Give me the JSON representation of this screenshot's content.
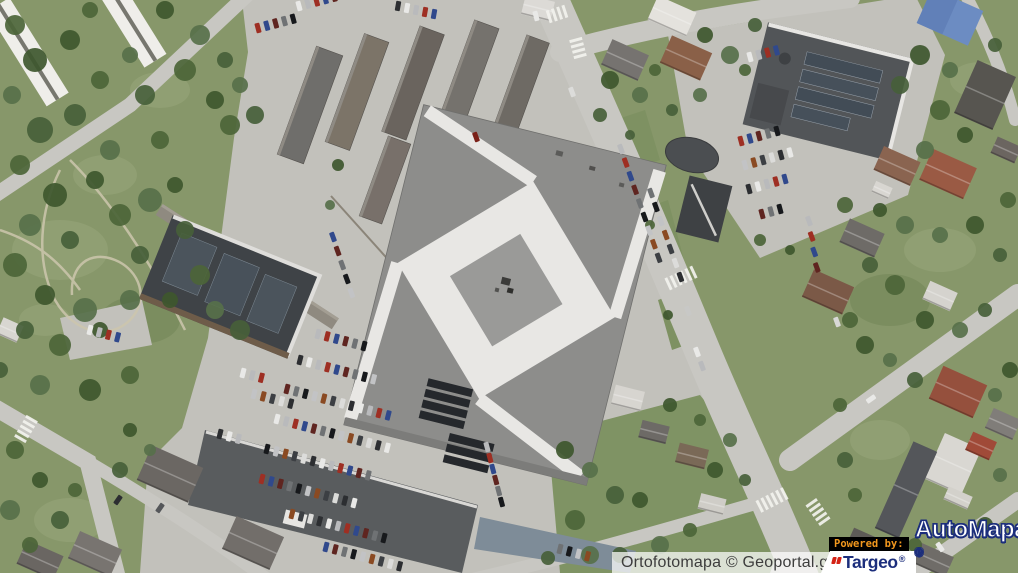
{
  "attribution": {
    "text": "Ortofotomapa © Geoportal.gov.pl"
  },
  "branding": {
    "powered_by": "Powered by:",
    "targeo": {
      "name": "Targeo",
      "registered": "®"
    },
    "automapa": {
      "name": "AutoMapa",
      "registered": "®"
    }
  },
  "colors": {
    "attribution_bg": "rgba(255,255,255,0.72)",
    "attribution_text": "#3d3d3d",
    "powered_by_bg": "#000000",
    "powered_by_text": "#f2981e",
    "targeo_bg": "#ffffff",
    "targeo_navy": "#1c2e7c",
    "targeo_red": "#d42316",
    "automapa_fill": "#ffffff",
    "automapa_outline": "#1c2e7c",
    "grass": "#87976a",
    "garden": "#7f9364",
    "pavement": "#c2c1bb",
    "road": "#c8c7c2",
    "mall_roof": "#8d8d8b",
    "roof_white": "#e8e7e4",
    "solar_dark": "#25282c",
    "tree": "#4c6538"
  }
}
